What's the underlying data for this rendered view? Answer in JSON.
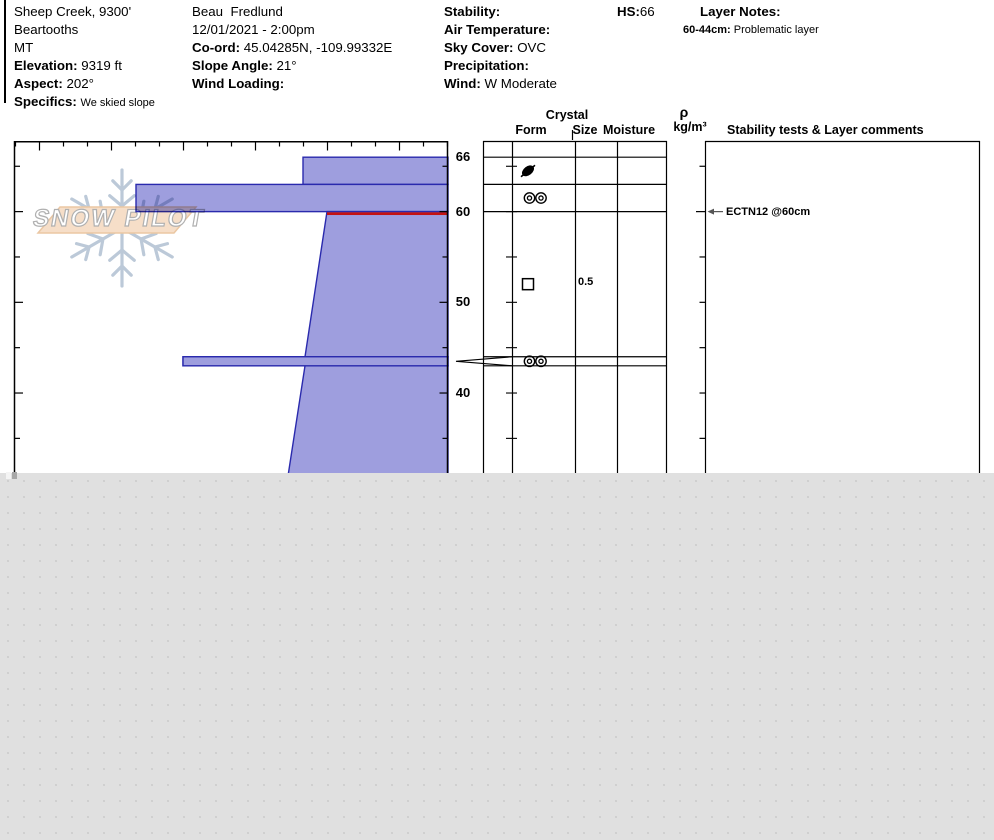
{
  "header": {
    "site": {
      "name": "Sheep Creek, 9300'",
      "range": "Beartooths",
      "state": "MT",
      "elevation_label": "Elevation:",
      "elevation": "9319 ft",
      "aspect_label": "Aspect:",
      "aspect": "202°",
      "specifics_label": "Specifics:",
      "specifics": "We skied slope"
    },
    "observer": {
      "name": "Beau  Fredlund",
      "datetime": "12/01/2021 - 2:00pm",
      "coord_label": "Co-ord:",
      "coord": "45.04285N, -109.99332E",
      "slope_angle_label": "Slope Angle:",
      "slope_angle": "21°",
      "wind_loading_label": "Wind Loading:",
      "wind_loading": ""
    },
    "weather": {
      "stability_label": "Stability:",
      "stability": "",
      "air_temp_label": "Air Temperature:",
      "air_temp": "",
      "sky_label": "Sky Cover:",
      "sky": "OVC",
      "precip_label": "Precipitation:",
      "precip": "",
      "wind_label": "Wind:",
      "wind": "W Moderate"
    },
    "hs_label": "HS:",
    "hs": "66",
    "layer_notes_label": "Layer Notes:",
    "layer_notes": [
      {
        "range": "60-44cm:",
        "text": "Problematic layer"
      }
    ]
  },
  "table_headers": {
    "crystal": "Crystal",
    "form": "Form",
    "size": "Size",
    "moisture": "Moisture",
    "rho": "ρ",
    "rho_units": "kg/m³",
    "comments": "Stability tests & Layer comments"
  },
  "watermark": {
    "text": "SNOW PILOT"
  },
  "chart_data": {
    "type": "bar",
    "title": "Snow pit hardness profile (hardness vs depth)",
    "orientation": "horizontal",
    "depth_unit": "cm",
    "depth_labels": [
      66,
      60,
      50,
      40
    ],
    "total_snow_height_cm": 66,
    "visible_bottom_cm": 31,
    "hardness_axis": {
      "note": "hand hardness, unlabeled ticks, harder extends left",
      "categories": [
        "F",
        "4F",
        "1F",
        "P",
        "K",
        "I"
      ]
    },
    "layers": [
      {
        "top_cm": 66,
        "bottom_cm": 63,
        "hardness": "4F",
        "symbol": "df",
        "grain_form": "decomposing fragments",
        "bar_left_px": 303
      },
      {
        "top_cm": 63,
        "bottom_cm": 60,
        "hardness": "P",
        "symbol": "rings",
        "grain_form": "rounded clusters",
        "bar_left_px": 136
      },
      {
        "top_cm": 60,
        "bottom_cm": 44,
        "hardness": "4F",
        "symbol": "square",
        "grain_form": "facets",
        "grain_size_mm": "0.5",
        "bar_left_px_top": 327,
        "bar_left_px_bottom": 305,
        "flagged_red_line": true
      },
      {
        "top_cm": 44,
        "bottom_cm": 43,
        "hardness": "P",
        "symbol": "rings",
        "grain_form": "rounded clusters",
        "bar_left_px": 183,
        "layer_of_concern": true
      },
      {
        "top_cm": 43,
        "bottom_cm": 31,
        "hardness": "4F",
        "bar_left_px_top": 305,
        "bar_left_px_bottom": 288
      }
    ],
    "annotations": [
      {
        "depth_cm": 60,
        "type": "stability-test",
        "text": "ECTN12 @60cm"
      }
    ],
    "colors": {
      "bar_fill": "#9e9ede",
      "bar_border": "#2a2aad",
      "flag_red": "#c41212",
      "axis": "#000000",
      "watermark_blue": "#b6c5d5",
      "banner_fill": "#f6dcc3",
      "banner_border": "#e9c29b"
    }
  }
}
